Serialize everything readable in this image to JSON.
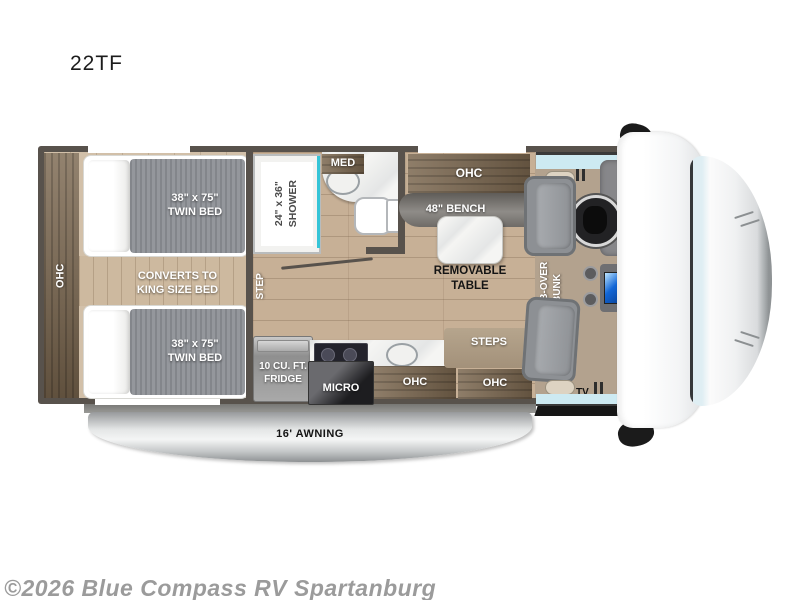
{
  "title": "22TF",
  "watermark": "©2026 Blue Compass RV Spartanburg",
  "colors": {
    "wall": "#58524c",
    "cabinet_wood": "#7b674f",
    "floor_wood": "#c7b096",
    "mattress_grey": "#8e9196",
    "accent_teal": "#35c4d7",
    "windshield_glass": "#cdeaf2",
    "cab_floor_tan": "#b3a28e",
    "awning_silver": "#d9dbdb",
    "table_white": "#ffffff"
  },
  "labels": {
    "rear_ohc": "OHC",
    "twin_bed_top": {
      "line1": "38\" x 75\"",
      "line2": "TWIN BED"
    },
    "king_convert": {
      "line1": "CONVERTS TO",
      "line2": "KING SIZE BED"
    },
    "twin_bed_bottom": {
      "line1": "38\" x 75\"",
      "line2": "TWIN BED"
    },
    "step": "STEP",
    "shower": {
      "line1": "24\" x 36\"",
      "line2": "SHOWER"
    },
    "med_cabinet": "MED",
    "dinette_ohc": "OHC",
    "bench": "48\" BENCH",
    "removable_table": {
      "line1": "REMOVABLE",
      "line2": "TABLE"
    },
    "cab_over_bunk": {
      "line1": "CAB-OVER",
      "line2": "BUNK"
    },
    "fridge": {
      "line1": "10 CU. FT.",
      "line2": "FRIDGE"
    },
    "micro": "MICRO",
    "kitchen_ohc": "OHC",
    "steps": "STEPS",
    "entry_ohc": "OHC",
    "tv": "TV",
    "awning": "16' AWNING"
  }
}
